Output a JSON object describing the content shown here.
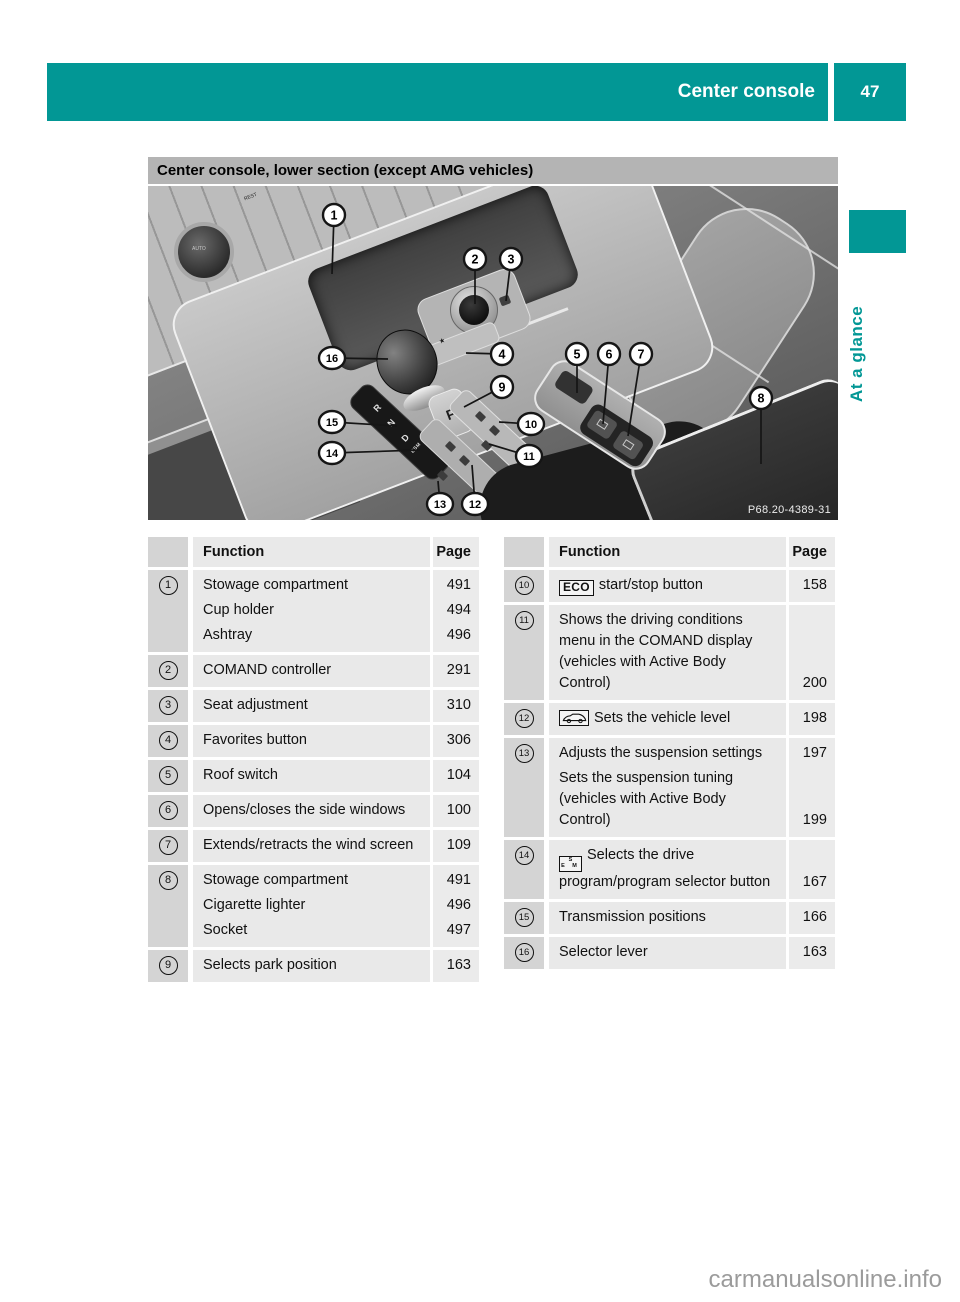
{
  "header": {
    "section": "Center console",
    "page_number": "47"
  },
  "side_tab": {
    "label": "At a glance"
  },
  "section_heading": "Center console, lower section (except AMG vehicles)",
  "figure": {
    "code": "P68.20-4389-31",
    "labels": {
      "auto": "AUTO",
      "rest": "REST",
      "park": "P",
      "star": "★"
    },
    "gear_letters": [
      "R",
      "N",
      "D",
      "ESM"
    ],
    "callouts": [
      {
        "n": "1",
        "cx": 186,
        "cy": 29,
        "lx": 184,
        "ly": 88
      },
      {
        "n": "2",
        "cx": 327,
        "cy": 73,
        "lx": 327,
        "ly": 118
      },
      {
        "n": "3",
        "cx": 363,
        "cy": 73,
        "lx": 358,
        "ly": 115
      },
      {
        "n": "4",
        "cx": 354,
        "cy": 168,
        "lx": 318,
        "ly": 167
      },
      {
        "n": "5",
        "cx": 429,
        "cy": 168,
        "lx": 429,
        "ly": 207
      },
      {
        "n": "6",
        "cx": 461,
        "cy": 168,
        "lx": 455,
        "ly": 238
      },
      {
        "n": "7",
        "cx": 493,
        "cy": 168,
        "lx": 480,
        "ly": 250
      },
      {
        "n": "8",
        "cx": 613,
        "cy": 212,
        "lx": 613,
        "ly": 278
      },
      {
        "n": "9",
        "cx": 354,
        "cy": 201,
        "lx": 316,
        "ly": 221
      },
      {
        "n": "10",
        "cx": 383,
        "cy": 238,
        "lx": 351,
        "ly": 236
      },
      {
        "n": "11",
        "cx": 381,
        "cy": 270,
        "lx": 341,
        "ly": 258
      },
      {
        "n": "12",
        "cx": 327,
        "cy": 318,
        "lx": 324,
        "ly": 279
      },
      {
        "n": "13",
        "cx": 292,
        "cy": 318,
        "lx": 290,
        "ly": 295
      },
      {
        "n": "14",
        "cx": 184,
        "cy": 267,
        "lx": 272,
        "ly": 264
      },
      {
        "n": "15",
        "cx": 184,
        "cy": 236,
        "lx": 249,
        "ly": 240
      },
      {
        "n": "16",
        "cx": 184,
        "cy": 172,
        "lx": 240,
        "ly": 173
      }
    ]
  },
  "tables": [
    {
      "headers": {
        "function": "Function",
        "page": "Page"
      },
      "rows": [
        {
          "num": "1",
          "entries": [
            {
              "text": "Stowage compartment",
              "page": "491"
            },
            {
              "text": "Cup holder",
              "page": "494"
            },
            {
              "text": "Ashtray",
              "page": "496"
            }
          ]
        },
        {
          "num": "2",
          "entries": [
            {
              "text": "COMAND controller",
              "page": "291"
            }
          ]
        },
        {
          "num": "3",
          "entries": [
            {
              "text": "Seat adjustment",
              "page": "310"
            }
          ]
        },
        {
          "num": "4",
          "entries": [
            {
              "text": "Favorites button",
              "page": "306"
            }
          ]
        },
        {
          "num": "5",
          "entries": [
            {
              "text": "Roof switch",
              "page": "104"
            }
          ]
        },
        {
          "num": "6",
          "entries": [
            {
              "text": "Opens/closes the side windows",
              "page": "100"
            }
          ]
        },
        {
          "num": "7",
          "entries": [
            {
              "text": "Extends/retracts the wind screen",
              "page": "109"
            }
          ]
        },
        {
          "num": "8",
          "entries": [
            {
              "text": "Stowage compartment",
              "page": "491"
            },
            {
              "text": "Cigarette lighter",
              "page": "496"
            },
            {
              "text": "Socket",
              "page": "497"
            }
          ]
        },
        {
          "num": "9",
          "entries": [
            {
              "text": "Selects park position",
              "page": "163"
            }
          ]
        }
      ]
    },
    {
      "headers": {
        "function": "Function",
        "page": "Page"
      },
      "rows": [
        {
          "num": "10",
          "entries": [
            {
              "icon": "eco",
              "icon_text": "ECO",
              "text": "start/stop button",
              "page": "158"
            }
          ]
        },
        {
          "num": "11",
          "entries": [
            {
              "text": "Shows the driving conditions menu in the COMAND display (vehicles with Active Body Control)",
              "page": "200"
            }
          ]
        },
        {
          "num": "12",
          "entries": [
            {
              "icon": "vehicle-level",
              "text": "Sets the vehicle level",
              "page": "198"
            }
          ]
        },
        {
          "num": "13",
          "entries": [
            {
              "text": "Adjusts the suspension settings",
              "page": "197"
            },
            {
              "text": "Sets the suspension tuning (vehicles with Active Body Control)",
              "page": "199"
            }
          ]
        },
        {
          "num": "14",
          "entries": [
            {
              "icon": "drive-program",
              "icon_top": "S",
              "icon_bottom": "E M",
              "text": "Selects the drive program/program selector button",
              "page": "167"
            }
          ]
        },
        {
          "num": "15",
          "entries": [
            {
              "text": "Transmission positions",
              "page": "166"
            }
          ]
        },
        {
          "num": "16",
          "entries": [
            {
              "text": "Selector lever",
              "page": "163"
            }
          ]
        }
      ]
    }
  ],
  "watermark": "carmanualsonline.info"
}
